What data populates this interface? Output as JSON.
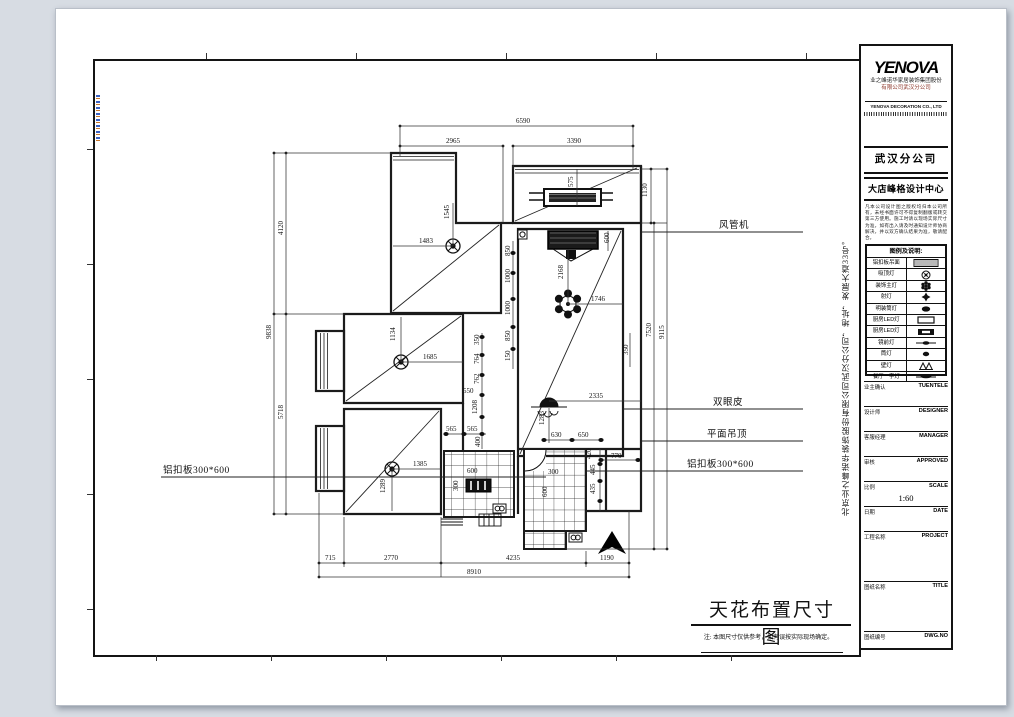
{
  "sheet": {
    "bg": "#ffffff",
    "canvas_bg": "#d7dce3",
    "line_color": "#141414"
  },
  "title_block": {
    "logo": "YENOVA",
    "company_cn_line1": "业之峰诺华家居装饰集团股份",
    "company_cn_line2": "有限公司武汉分公司",
    "company_en": "YENOVA DECORATION CO., LTD",
    "branch": "武汉分公司",
    "design_center": "大店峰格设计中心",
    "disclaimer": "凡本公司设计图之版权均归本公司所有，未经书面许可不得复制翻版或转交第三方使用。施工时请以现场实际尺寸为准，如有出入请及时通知设计师协商解决，并以双方确认结果为准，敬请配合。",
    "legend_title": "图例及说明:",
    "legend": [
      {
        "label": "铝扣板吊面",
        "sym": "panel"
      },
      {
        "label": "吸顶灯",
        "sym": "ceiling"
      },
      {
        "label": "装饰主灯",
        "sym": "main"
      },
      {
        "label": "射灯",
        "sym": "spot"
      },
      {
        "label": "明装筒灯",
        "sym": "surface"
      },
      {
        "label": "厨房LED灯",
        "sym": "led-open"
      },
      {
        "label": "厨房LED灯",
        "sym": "led-solid"
      },
      {
        "label": "镜前灯",
        "sym": "mirror"
      },
      {
        "label": "筒灯",
        "sym": "down"
      },
      {
        "label": "壁灯",
        "sym": "wall"
      },
      {
        "label": "餐厅一字灯",
        "sym": "linear"
      }
    ],
    "fields": [
      {
        "cn": "业主确认",
        "en": "TUENTELE"
      },
      {
        "cn": "设计师",
        "en": "DESIGNER"
      },
      {
        "cn": "客服经理",
        "en": "MANAGER"
      },
      {
        "cn": "审核",
        "en": "APPROVED"
      },
      {
        "cn": "比例",
        "en": "SCALE",
        "value": "1:60"
      },
      {
        "cn": "日期",
        "en": "DATE"
      },
      {
        "cn": "工程名称",
        "en": "PROJECT"
      },
      {
        "cn": "图纸名称",
        "en": "TITLE"
      },
      {
        "cn": "图纸编号",
        "en": "DWG.NO"
      }
    ]
  },
  "side_text": "北京业之峰诺华装饰股份有限公司武汉分公司，地址，发展大道33号。",
  "drawing": {
    "title": "天花布置尺寸图",
    "note": "注: 本图尺寸仅供参考，如有误按实际现场确定。",
    "labels": [
      {
        "t": "风管机",
        "tx": 618,
        "ty": 147,
        "line": [
          540,
          151,
          702,
          151
        ]
      },
      {
        "t": "双眼皮",
        "tx": 612,
        "ty": 324,
        "line": [
          522,
          328,
          702,
          328
        ]
      },
      {
        "t": "平面吊顶",
        "tx": 606,
        "ty": 356,
        "line": [
          540,
          360,
          702,
          360
        ]
      },
      {
        "t": "铝扣板300*600",
        "tx": 586,
        "ty": 386,
        "line": [
          485,
          390,
          702,
          390
        ]
      },
      {
        "t": "铝扣板300*600",
        "tx": 62,
        "ty": 392,
        "line": [
          60,
          396,
          445,
          396
        ]
      }
    ],
    "dims": [
      {
        "t": "6590",
        "x": 415,
        "y": 42
      },
      {
        "t": "2965",
        "x": 345,
        "y": 62
      },
      {
        "t": "3390",
        "x": 466,
        "y": 62
      },
      {
        "t": "9838",
        "x": 170,
        "y": 258,
        "r": 1
      },
      {
        "t": "4120",
        "x": 182,
        "y": 154,
        "r": 1
      },
      {
        "t": "5718",
        "x": 182,
        "y": 338,
        "r": 1
      },
      {
        "t": "1130",
        "x": 546,
        "y": 116,
        "r": 1
      },
      {
        "t": "7520",
        "x": 550,
        "y": 256,
        "r": 1
      },
      {
        "t": "9115",
        "x": 563,
        "y": 258,
        "r": 1
      },
      {
        "t": "350",
        "x": 527,
        "y": 274,
        "r": 1
      },
      {
        "t": "575",
        "x": 472,
        "y": 106,
        "r": 1
      },
      {
        "t": "600",
        "x": 508,
        "y": 162,
        "r": 1
      },
      {
        "t": "1545",
        "x": 348,
        "y": 138,
        "r": 1
      },
      {
        "t": "1483",
        "x": 318,
        "y": 162
      },
      {
        "t": "2168",
        "x": 462,
        "y": 198,
        "r": 1
      },
      {
        "t": "1746",
        "x": 490,
        "y": 220
      },
      {
        "t": "2335",
        "x": 488,
        "y": 317
      },
      {
        "t": "1283",
        "x": 443,
        "y": 344,
        "r": 1
      },
      {
        "t": "850",
        "x": 409,
        "y": 175,
        "r": 1
      },
      {
        "t": "1000",
        "x": 409,
        "y": 202,
        "r": 1
      },
      {
        "t": "1000",
        "x": 409,
        "y": 234,
        "r": 1
      },
      {
        "t": "850",
        "x": 409,
        "y": 260,
        "r": 1
      },
      {
        "t": "150",
        "x": 409,
        "y": 280,
        "r": 1
      },
      {
        "t": "350",
        "x": 378,
        "y": 264,
        "r": 1
      },
      {
        "t": "764",
        "x": 378,
        "y": 283,
        "r": 1
      },
      {
        "t": "762",
        "x": 378,
        "y": 303,
        "r": 1
      },
      {
        "t": "550",
        "x": 362,
        "y": 312
      },
      {
        "t": "1208",
        "x": 376,
        "y": 333,
        "r": 1
      },
      {
        "t": "565",
        "x": 345,
        "y": 350
      },
      {
        "t": "565",
        "x": 366,
        "y": 350
      },
      {
        "t": "400",
        "x": 379,
        "y": 366,
        "r": 1
      },
      {
        "t": "1134",
        "x": 294,
        "y": 260,
        "r": 1
      },
      {
        "t": "1685",
        "x": 322,
        "y": 278
      },
      {
        "t": "1385",
        "x": 312,
        "y": 385
      },
      {
        "t": "1289",
        "x": 284,
        "y": 412,
        "r": 1
      },
      {
        "t": "600",
        "x": 366,
        "y": 392
      },
      {
        "t": "300",
        "x": 357,
        "y": 410,
        "r": 1
      },
      {
        "t": "300",
        "x": 447,
        "y": 393
      },
      {
        "t": "600",
        "x": 446,
        "y": 416,
        "r": 1
      },
      {
        "t": "630",
        "x": 450,
        "y": 356
      },
      {
        "t": "650",
        "x": 477,
        "y": 356
      },
      {
        "t": "420",
        "x": 490,
        "y": 378,
        "r": 1
      },
      {
        "t": "770",
        "x": 510,
        "y": 377
      },
      {
        "t": "445",
        "x": 494,
        "y": 394,
        "r": 1
      },
      {
        "t": "435",
        "x": 494,
        "y": 413,
        "r": 1
      },
      {
        "t": "715",
        "x": 224,
        "y": 479
      },
      {
        "t": "2770",
        "x": 283,
        "y": 479
      },
      {
        "t": "4235",
        "x": 405,
        "y": 479
      },
      {
        "t": "1190",
        "x": 499,
        "y": 479
      },
      {
        "t": "8910",
        "x": 366,
        "y": 493
      }
    ]
  }
}
